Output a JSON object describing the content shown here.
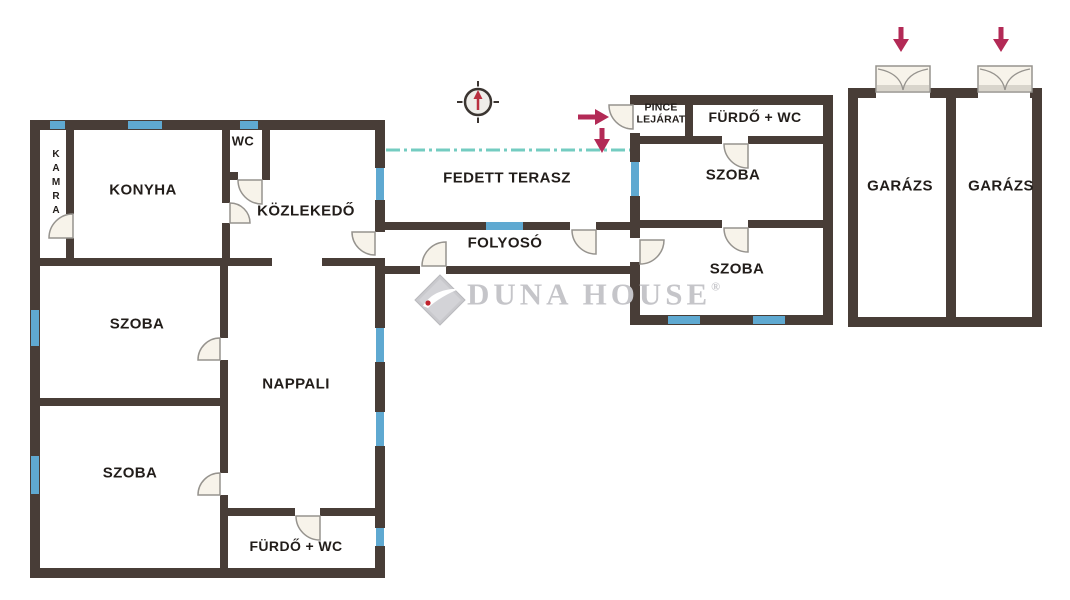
{
  "rooms": {
    "kamra": "KAMRA",
    "konyha": "KONYHA",
    "wc": "WC",
    "kozlekedo": "KÖZLEKEDŐ",
    "szoba1": "SZOBA",
    "szoba2": "SZOBA",
    "nappali": "NAPPALI",
    "furdo_main": "FÜRDŐ + WC",
    "fedett_terasz": "FEDETT TERASZ",
    "folyoso": "FOLYOSÓ",
    "pince_line1": "PINCE",
    "pince_line2": "LEJÁRAT",
    "furdo_right": "FÜRDŐ + WC",
    "szoba3": "SZOBA",
    "szoba4": "SZOBA",
    "garazs1": "GARÁZS",
    "garazs2": "GARÁZS"
  },
  "watermark": {
    "text": "DUNA HOUSE",
    "reg": "®"
  },
  "icons": {
    "compass": "compass-north-icon",
    "entrance_arrows": "entrance-direction-arrows",
    "garage_arrows": "garage-entry-arrows",
    "roof_edge": "covered-terrace-roof-edge-line",
    "windows": "window-segment",
    "doors": "door-swing-arc"
  },
  "colors": {
    "wall": "#483d37",
    "window": "#5fa9d1",
    "door_fill": "#f7f3ea",
    "door_stroke": "#96938e",
    "roof_line": "#74ccc1",
    "arrow": "#b32a56",
    "label": "#221d1a",
    "watermark_gray": "#c5c5c9",
    "logo_diamond": "#c9c9cd",
    "logo_dot": "#c0222c"
  }
}
